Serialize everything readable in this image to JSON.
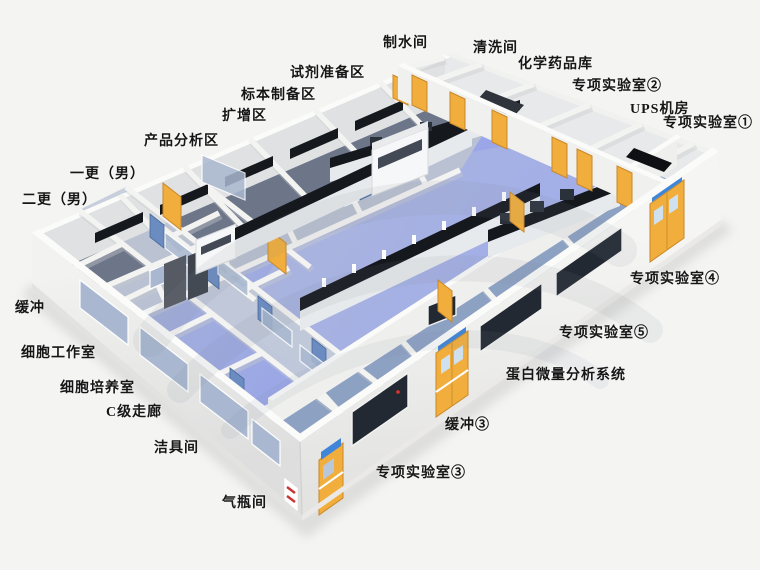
{
  "scene": {
    "kind": "3d-isometric-laboratory-floorplan-rendering",
    "watermark_present": true,
    "palette": {
      "bg": "#f4f4f3",
      "floor": "#9aa9c6",
      "floor-dark": "#6d7689",
      "floor-light": "#bcc4d4",
      "wall": "#f3f3f1",
      "wall-top": "#fbfbfa",
      "wall-shade": "#c7cacc",
      "door-yellow": "#f2ae3c",
      "door-yellow-dark": "#c9882a",
      "door-blue": "#6a8cc0",
      "bench-top": "#15181d",
      "bench-body": "#e7eaed",
      "glass": "#a9b8d0",
      "glass-dark": "#232932",
      "sign-blue": "#3f86d8",
      "sign-red": "#cc3333",
      "label": "#161616",
      "watermark": "#7d8796"
    }
  },
  "labels": [
    {
      "id": "water-production-room",
      "text": "制水间",
      "x": 383,
      "y": 36
    },
    {
      "id": "washing-room",
      "text": "清洗间",
      "x": 473,
      "y": 41
    },
    {
      "id": "chemical-storage",
      "text": "化学药品库",
      "x": 518,
      "y": 57
    },
    {
      "id": "special-lab-2",
      "text": "专项实验室②",
      "x": 572,
      "y": 79
    },
    {
      "id": "ups-room",
      "text": "UPS机房",
      "x": 630,
      "y": 102
    },
    {
      "id": "special-lab-1",
      "text": "专项实验室①",
      "x": 663,
      "y": 116
    },
    {
      "id": "reagent-prep-area",
      "text": "试剂准备区",
      "x": 290,
      "y": 66
    },
    {
      "id": "specimen-prep-area",
      "text": "标本制备区",
      "x": 241,
      "y": 88
    },
    {
      "id": "amplification-area",
      "text": "扩增区",
      "x": 222,
      "y": 109
    },
    {
      "id": "product-analysis-area",
      "text": "产品分析区",
      "x": 144,
      "y": 134
    },
    {
      "id": "first-change-male",
      "text": "一更（男）",
      "x": 70,
      "y": 167
    },
    {
      "id": "second-change-male",
      "text": "二更（男）",
      "x": 22,
      "y": 193
    },
    {
      "id": "buffer",
      "text": "缓冲",
      "x": 15,
      "y": 301
    },
    {
      "id": "cell-workroom",
      "text": "细胞工作室",
      "x": 21,
      "y": 346
    },
    {
      "id": "cell-culture-room",
      "text": "细胞培养室",
      "x": 60,
      "y": 381
    },
    {
      "id": "c-grade-corridor",
      "text": "C级走廊",
      "x": 106,
      "y": 405
    },
    {
      "id": "cleaning-tools-room",
      "text": "洁具间",
      "x": 154,
      "y": 441
    },
    {
      "id": "gas-cylinder-room",
      "text": "气瓶间",
      "x": 222,
      "y": 496
    },
    {
      "id": "special-lab-3",
      "text": "专项实验室③",
      "x": 376,
      "y": 466
    },
    {
      "id": "buffer-3",
      "text": "缓冲③",
      "x": 445,
      "y": 418
    },
    {
      "id": "protein-micro-analysis",
      "text": "蛋白微量分析系统",
      "x": 506,
      "y": 368
    },
    {
      "id": "special-lab-5",
      "text": "专项实验室⑤",
      "x": 559,
      "y": 326
    },
    {
      "id": "special-lab-4",
      "text": "专项实验室④",
      "x": 630,
      "y": 272
    }
  ]
}
